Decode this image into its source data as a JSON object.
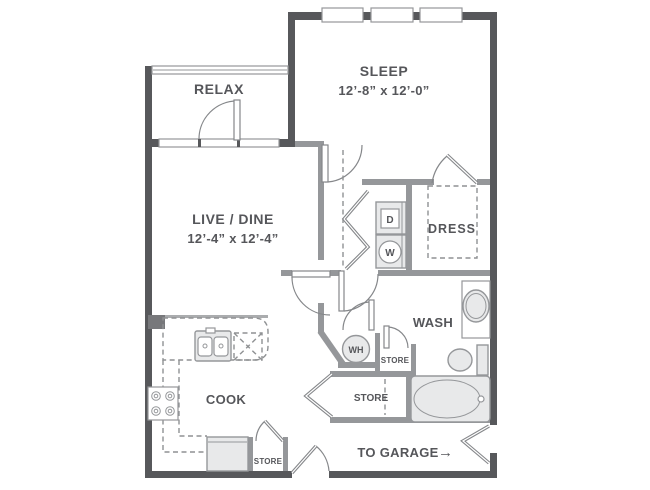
{
  "colors": {
    "wall_exterior": "#57585b",
    "wall_interior": "#95979a",
    "fixture_fill": "#e8e9ea",
    "fixture_stroke": "#95979a",
    "dashed_line": "#8f9193",
    "label_text": "#55565a",
    "background": "#ffffff"
  },
  "rooms": {
    "relax": {
      "label": "RELAX"
    },
    "sleep": {
      "label": "SLEEP",
      "dims": "12’-8” x 12’-0”"
    },
    "live_dine": {
      "label": "LIVE / DINE",
      "dims": "12’-4” x 12’-4”"
    },
    "dress": {
      "label": "DRESS"
    },
    "wash": {
      "label": "WASH"
    },
    "cook": {
      "label": "COOK"
    }
  },
  "labels": {
    "dryer": "D",
    "washer": "W",
    "water_heater": "WH",
    "store_linen": "STORE",
    "store_hall": "STORE",
    "store_pantry": "STORE",
    "to_garage": "TO GARAGE",
    "garage_arrow": "→"
  }
}
